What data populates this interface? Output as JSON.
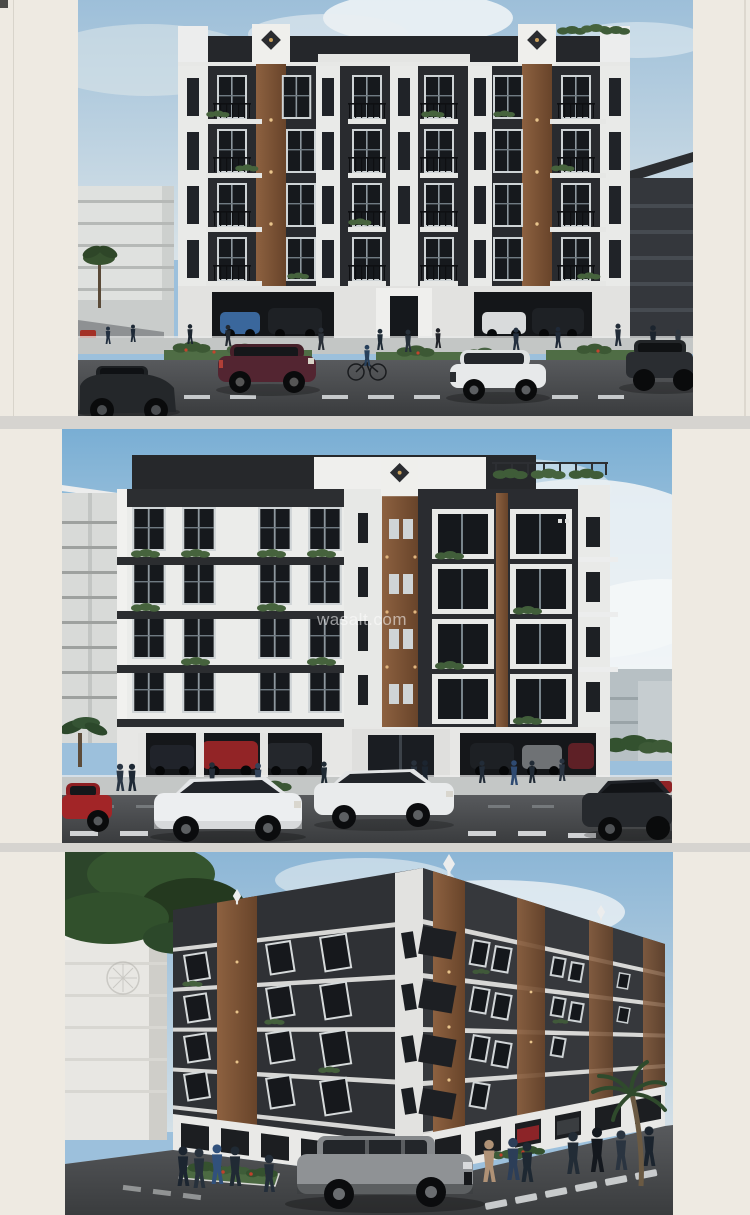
{
  "watermark": {
    "text": "wasalt.com"
  },
  "panels": [
    {
      "label": "front elevation render"
    },
    {
      "label": "side elevation render"
    },
    {
      "label": "corner perspective render"
    }
  ],
  "colors": {
    "page_margin": "#eeeae2",
    "separator": "#d6d4d0",
    "facade_dark": "#2a2c30",
    "facade_white": "#e9eae8",
    "accent_wood": "#85593a",
    "sky": "#9cc0dc",
    "road": "#45474a",
    "greenery": "#4a653f"
  }
}
